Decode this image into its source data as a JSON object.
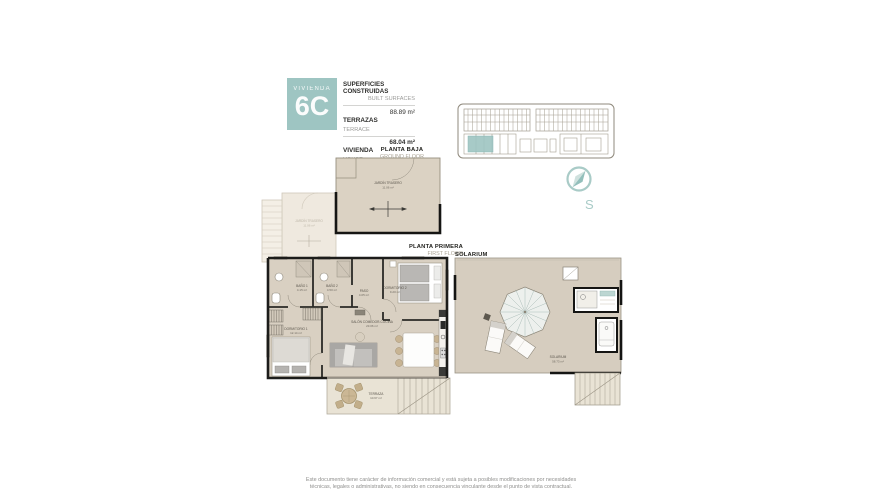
{
  "header": {
    "unit_label": "VIVIENDA",
    "unit_code": "6C",
    "built_title": "SUPERFICIES CONSTRUIDAS",
    "built_subtitle": "BUILT SURFACES",
    "terrace_label": "TERRAZAS",
    "terrace_sublabel": "TERRACE",
    "terrace_value": "88.89 m²",
    "house_label": "VIVIENDA",
    "house_sublabel": "HOUSE",
    "house_value": "68.04 m²"
  },
  "compass": {
    "south_label": "S"
  },
  "plans": {
    "ground": {
      "title": "PLANTA BAJA",
      "subtitle": "GROUND FLOOR",
      "garden": {
        "name": "JARDÍN TRASERO",
        "area": "11.06 m²"
      },
      "garden_adjacent": {
        "name": "JARDÍN TRASERO",
        "area": "11.06 m²"
      }
    },
    "first": {
      "title": "PLANTA PRIMERA",
      "subtitle": "FIRST FLOOR",
      "rooms": {
        "bano1": {
          "name": "BAÑO 1",
          "area": "4.15 m²"
        },
        "bano2": {
          "name": "BAÑO 2",
          "area": "4.50 m²"
        },
        "paso": {
          "name": "PASO",
          "area": "4.05 m²"
        },
        "dorm2": {
          "name": "DORMITORIO 2",
          "area": "9.20 m²"
        },
        "dorm1": {
          "name": "DORMITORIO 1",
          "area": "12.14 m²"
        },
        "salon": {
          "name": "SALÓN COMEDOR-COCINA",
          "area": "23.06 m²"
        },
        "terraza": {
          "name": "TERRAZA",
          "area": "10.67 m²"
        }
      }
    },
    "solarium": {
      "title": "SOLARIUM",
      "room": {
        "name": "SOLARIUM",
        "area": "58.73 m²"
      }
    }
  },
  "footer": {
    "line1": "Este documento tiene carácter de información comercial y está sujeta a posibles modificaciones por necesidades",
    "line2": "técnicas, legales o administrativas, no siendo en consecuencia vinculante desde el punto de vista contractual."
  },
  "colors": {
    "accent": "#9ec5c2",
    "wall": "#1a1a18",
    "floor": "#d9d0c2",
    "terrace_floor": "#e9e3d5"
  }
}
